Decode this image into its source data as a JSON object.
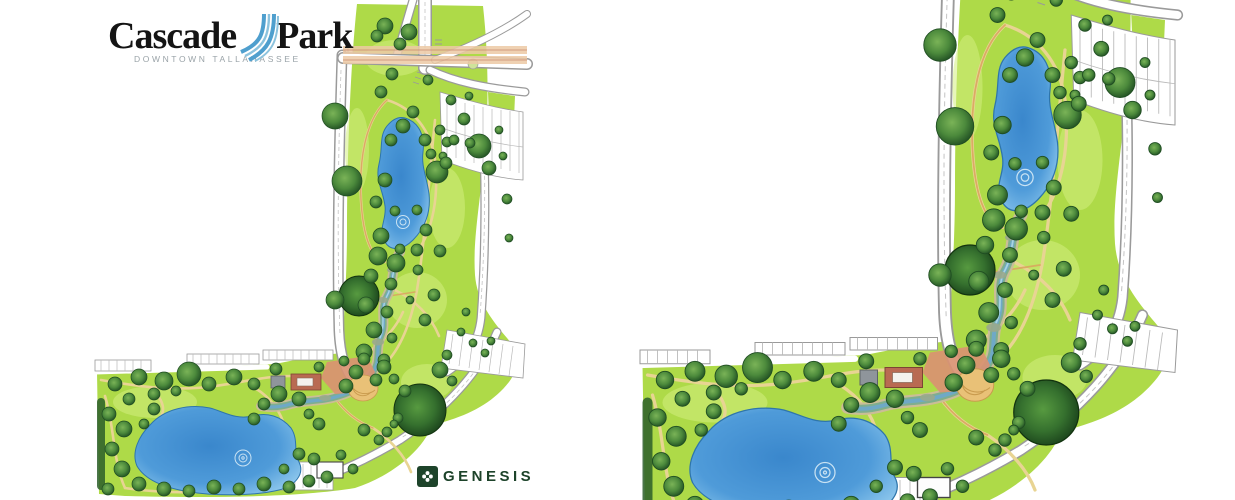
{
  "page": {
    "background": "#ffffff",
    "description": "Scanned park master plan shown twice side by side"
  },
  "branding": {
    "title_left": "Cascade",
    "title_right": "Park",
    "subtitle": "DOWNTOWN TALLAHASSEE",
    "cascade_icon": "waterfall-cascade-icon"
  },
  "footer_logo": {
    "text": "GENESIS",
    "icon": "clover-pinwheel-icon"
  },
  "palette": {
    "brand_text": "#141414",
    "brand_sub": "#9aa3a8",
    "cascade_blue": "#4f9fce",
    "cascade_blue_light": "#8cc3de",
    "genesis_green": "#1d432a",
    "lawn": "#aeda48",
    "lawn_patch": "#d3ee7f",
    "hedge": "#2c5e2a",
    "road_fill": "#ffffff",
    "road_casing": "#9a9a9a",
    "band": "#ecc9a4",
    "band_line": "#c8876e",
    "water_deep": "#3a87cc",
    "water_mid": "#4f9bd9",
    "water_light": "#8cc6ec",
    "water_edge": "#2e75ab",
    "stream_bank": "#cbbd96",
    "stream_marsh": "#7fae8e",
    "stream_water": "#6fa9c6",
    "stream_hi": "#a8d4e2",
    "rock": "#9aa98c",
    "path": "#e8d493",
    "path_accent": "#d9a65e",
    "plaza": "#d99372",
    "amph": "#e9c177",
    "amph_line": "#c99b4e",
    "building_red": "#b96a52",
    "tree_hi": "#7ab357",
    "tree_mid": "#4c8a3c",
    "tree_edge": "#1f4d22",
    "tree_big_hi": "#579a40",
    "tree_big_mid": "#35702e",
    "tree_big_edge": "#173d19"
  },
  "map": {
    "panels": [
      {
        "name": "site-plan-left",
        "label": "Cascade Park site plan — full extent with road crossing"
      },
      {
        "name": "site-plan-right",
        "label": "Cascade Park site plan — enlarged crop"
      }
    ],
    "features": {
      "upper_pond": "upper retention pond",
      "stream": "winding cascade stream",
      "lower_pond": "main park pond",
      "plaza": "amphitheater plaza",
      "parking_upper": "north parking lot",
      "parking_southeast": "southeast parking",
      "road_band": "street crossing band"
    },
    "trees": [
      [
        240,
        116,
        13
      ],
      [
        252,
        181,
        15
      ],
      [
        264,
        296,
        20
      ],
      [
        240,
        300,
        9
      ],
      [
        290,
        26,
        8
      ],
      [
        314,
        32,
        8
      ],
      [
        282,
        36,
        6
      ],
      [
        297,
        74,
        6
      ],
      [
        286,
        92,
        6
      ],
      [
        305,
        44,
        6
      ],
      [
        333,
        80,
        5
      ],
      [
        308,
        126,
        7
      ],
      [
        296,
        140,
        6
      ],
      [
        342,
        172,
        11
      ],
      [
        290,
        180,
        7
      ],
      [
        281,
        202,
        6
      ],
      [
        300,
        211,
        5
      ],
      [
        286,
        236,
        8
      ],
      [
        318,
        112,
        6
      ],
      [
        330,
        140,
        6
      ],
      [
        336,
        154,
        5
      ],
      [
        322,
        250,
        6
      ],
      [
        305,
        249,
        5
      ],
      [
        345,
        130,
        5
      ],
      [
        352,
        142,
        5
      ],
      [
        348,
        156,
        4
      ],
      [
        283,
        256,
        9
      ],
      [
        301,
        263,
        9
      ],
      [
        276,
        276,
        7
      ],
      [
        296,
        284,
        6
      ],
      [
        271,
        305,
        8
      ],
      [
        292,
        312,
        6
      ],
      [
        279,
        330,
        8
      ],
      [
        297,
        338,
        5
      ],
      [
        269,
        352,
        8
      ],
      [
        289,
        360,
        6
      ],
      [
        261,
        372,
        7
      ],
      [
        281,
        380,
        6
      ],
      [
        251,
        386,
        7
      ],
      [
        331,
        230,
        6
      ],
      [
        345,
        251,
        6
      ],
      [
        323,
        270,
        5
      ],
      [
        339,
        295,
        6
      ],
      [
        330,
        320,
        6
      ],
      [
        315,
        300,
        4
      ],
      [
        322,
        210,
        5
      ],
      [
        325,
        410,
        26
      ],
      [
        345,
        370,
        8
      ],
      [
        357,
        381,
        5
      ],
      [
        310,
        391,
        6
      ],
      [
        352,
        355,
        5
      ],
      [
        303,
        418,
        5
      ],
      [
        292,
        432,
        5
      ],
      [
        356,
        100,
        5
      ],
      [
        369,
        119,
        6
      ],
      [
        384,
        146,
        12
      ],
      [
        359,
        140,
        5
      ],
      [
        351,
        163,
        6
      ],
      [
        394,
        168,
        7
      ],
      [
        374,
        96,
        4
      ],
      [
        404,
        130,
        4
      ],
      [
        408,
        156,
        4
      ],
      [
        412,
        199,
        5
      ],
      [
        414,
        238,
        4
      ],
      [
        375,
        143,
        5
      ],
      [
        366,
        332,
        4
      ],
      [
        378,
        343,
        4
      ],
      [
        390,
        353,
        4
      ],
      [
        371,
        312,
        4
      ],
      [
        396,
        341,
        4
      ],
      [
        20,
        384,
        7
      ],
      [
        44,
        377,
        8
      ],
      [
        69,
        381,
        9
      ],
      [
        94,
        374,
        12
      ],
      [
        114,
        384,
        7
      ],
      [
        139,
        377,
        8
      ],
      [
        159,
        384,
        6
      ],
      [
        59,
        394,
        6
      ],
      [
        34,
        399,
        6
      ],
      [
        81,
        391,
        5
      ],
      [
        14,
        414,
        7
      ],
      [
        29,
        429,
        8
      ],
      [
        17,
        449,
        7
      ],
      [
        27,
        469,
        8
      ],
      [
        44,
        484,
        7
      ],
      [
        13,
        489,
        6
      ],
      [
        59,
        409,
        6
      ],
      [
        49,
        424,
        5
      ],
      [
        69,
        489,
        7
      ],
      [
        94,
        491,
        6
      ],
      [
        119,
        487,
        7
      ],
      [
        144,
        489,
        6
      ],
      [
        169,
        484,
        7
      ],
      [
        194,
        487,
        6
      ],
      [
        214,
        481,
        6
      ],
      [
        232,
        477,
        6
      ],
      [
        184,
        394,
        8
      ],
      [
        204,
        399,
        7
      ],
      [
        169,
        404,
        6
      ],
      [
        159,
        419,
        6
      ],
      [
        214,
        414,
        5
      ],
      [
        224,
        424,
        6
      ],
      [
        204,
        454,
        6
      ],
      [
        219,
        459,
        6
      ],
      [
        189,
        469,
        5
      ],
      [
        246,
        455,
        5
      ],
      [
        258,
        469,
        5
      ],
      [
        269,
        430,
        6
      ],
      [
        284,
        440,
        5
      ],
      [
        299,
        424,
        4
      ],
      [
        181,
        369,
        6
      ],
      [
        224,
        367,
        5
      ],
      [
        249,
        361,
        5
      ],
      [
        269,
        359,
        6
      ],
      [
        289,
        367,
        7
      ],
      [
        299,
        379,
        5
      ]
    ]
  }
}
